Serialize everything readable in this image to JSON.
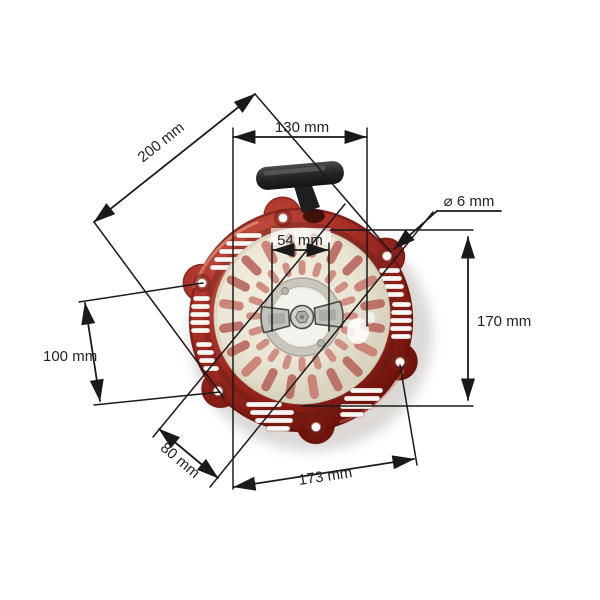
{
  "image_subject": "recoil-pull-starter",
  "labels": {
    "d200": "200 mm",
    "d130": "130 mm",
    "d54": "54 mm",
    "d6": "⌀ 6 mm",
    "d170": "170 mm",
    "d100": "100 mm",
    "d80": "80 mm",
    "d173": "173 mm"
  },
  "values_mm": {
    "d200": 200,
    "d130": 130,
    "d54": 54,
    "d6": 6,
    "d170": 170,
    "d100": 100,
    "d80": 80,
    "d173": 173
  },
  "colors": {
    "housing_red": "#ae332a",
    "housing_red_dark": "#6f130c",
    "pulley_cream": "#ece7d8",
    "slot_rose": "#c07265",
    "hub_grey": "#c9c6bc",
    "handle_black": "#222222",
    "annotation": "#1a1a1a",
    "label_text": "#222222",
    "background": "#ffffff"
  }
}
